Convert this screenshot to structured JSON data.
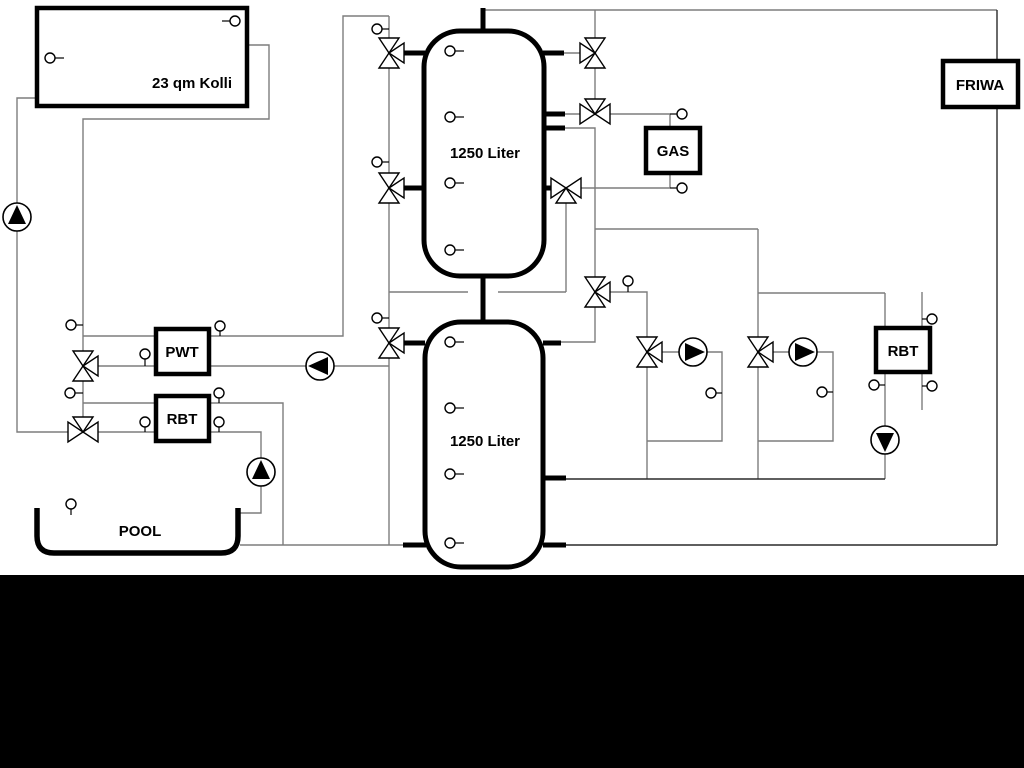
{
  "diagram": {
    "type": "heating-solar-pool-hydraulic-schematic",
    "labels": {
      "collector": "23 qm Kolli",
      "tank_top": "1250 Liter",
      "tank_bottom": "1250 Liter",
      "pwt": "PWT",
      "rbt_left": "RBT",
      "rbt_right": "RBT",
      "gas": "GAS",
      "friwa": "FRIWA",
      "pool": "POOL"
    },
    "colors": {
      "background": "#ffffff",
      "pipe_gray": "#7d7d7d",
      "pipe_dark": "#2a2a2a",
      "component_outline": "#000000",
      "bottom_band": "#000000"
    },
    "components": {
      "three_way_valves": 11,
      "pumps": 6,
      "temperature_sensors": 23
    }
  }
}
